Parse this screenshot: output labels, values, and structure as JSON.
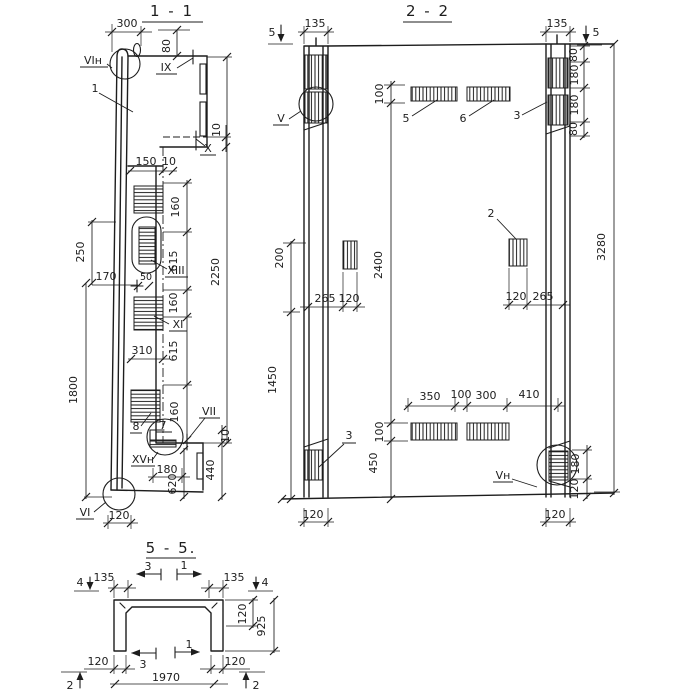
{
  "drawing": {
    "s11": {
      "title": "1 - 1",
      "refs": {
        "vin": "VIн",
        "one": "1",
        "ix": "IX",
        "x": "X",
        "xiii": "XIII",
        "xi": "XI",
        "eight": "8",
        "seven": "7",
        "vii": "VII",
        "xvn": "XVн",
        "vi": "VI"
      },
      "dims": {
        "d300": "300",
        "d80": "80",
        "d150": "150",
        "d10": "10",
        "d160": "160",
        "d615": "615",
        "d2250": "2250",
        "d250": "250",
        "d170": "170",
        "d50": "50",
        "d310": "310",
        "d1800": "1800",
        "d180": "180",
        "d620": "620",
        "d440": "440",
        "d120": "120"
      }
    },
    "s22": {
      "title": "2 - 2",
      "marks": {
        "m5": "5"
      },
      "refs": {
        "v": "V",
        "vn": "Vн",
        "r2": "2",
        "r3": "3",
        "r5": "5",
        "r6": "6"
      },
      "dims": {
        "d135": "135",
        "d100": "100",
        "d200": "200",
        "d1450": "1450",
        "d265": "265",
        "d120": "120",
        "d2400": "2400",
        "d80": "80",
        "d180": "180",
        "d3280": "3280",
        "d350": "350",
        "d300": "300",
        "d410": "410",
        "d450": "450"
      }
    },
    "s55": {
      "title": "5 - 5.",
      "marks": {
        "m4": "4",
        "m3": "3",
        "m1": "1",
        "m2": "2"
      },
      "dims": {
        "d135": "135",
        "d120": "120",
        "d925": "925",
        "d1970": "1970"
      }
    }
  }
}
